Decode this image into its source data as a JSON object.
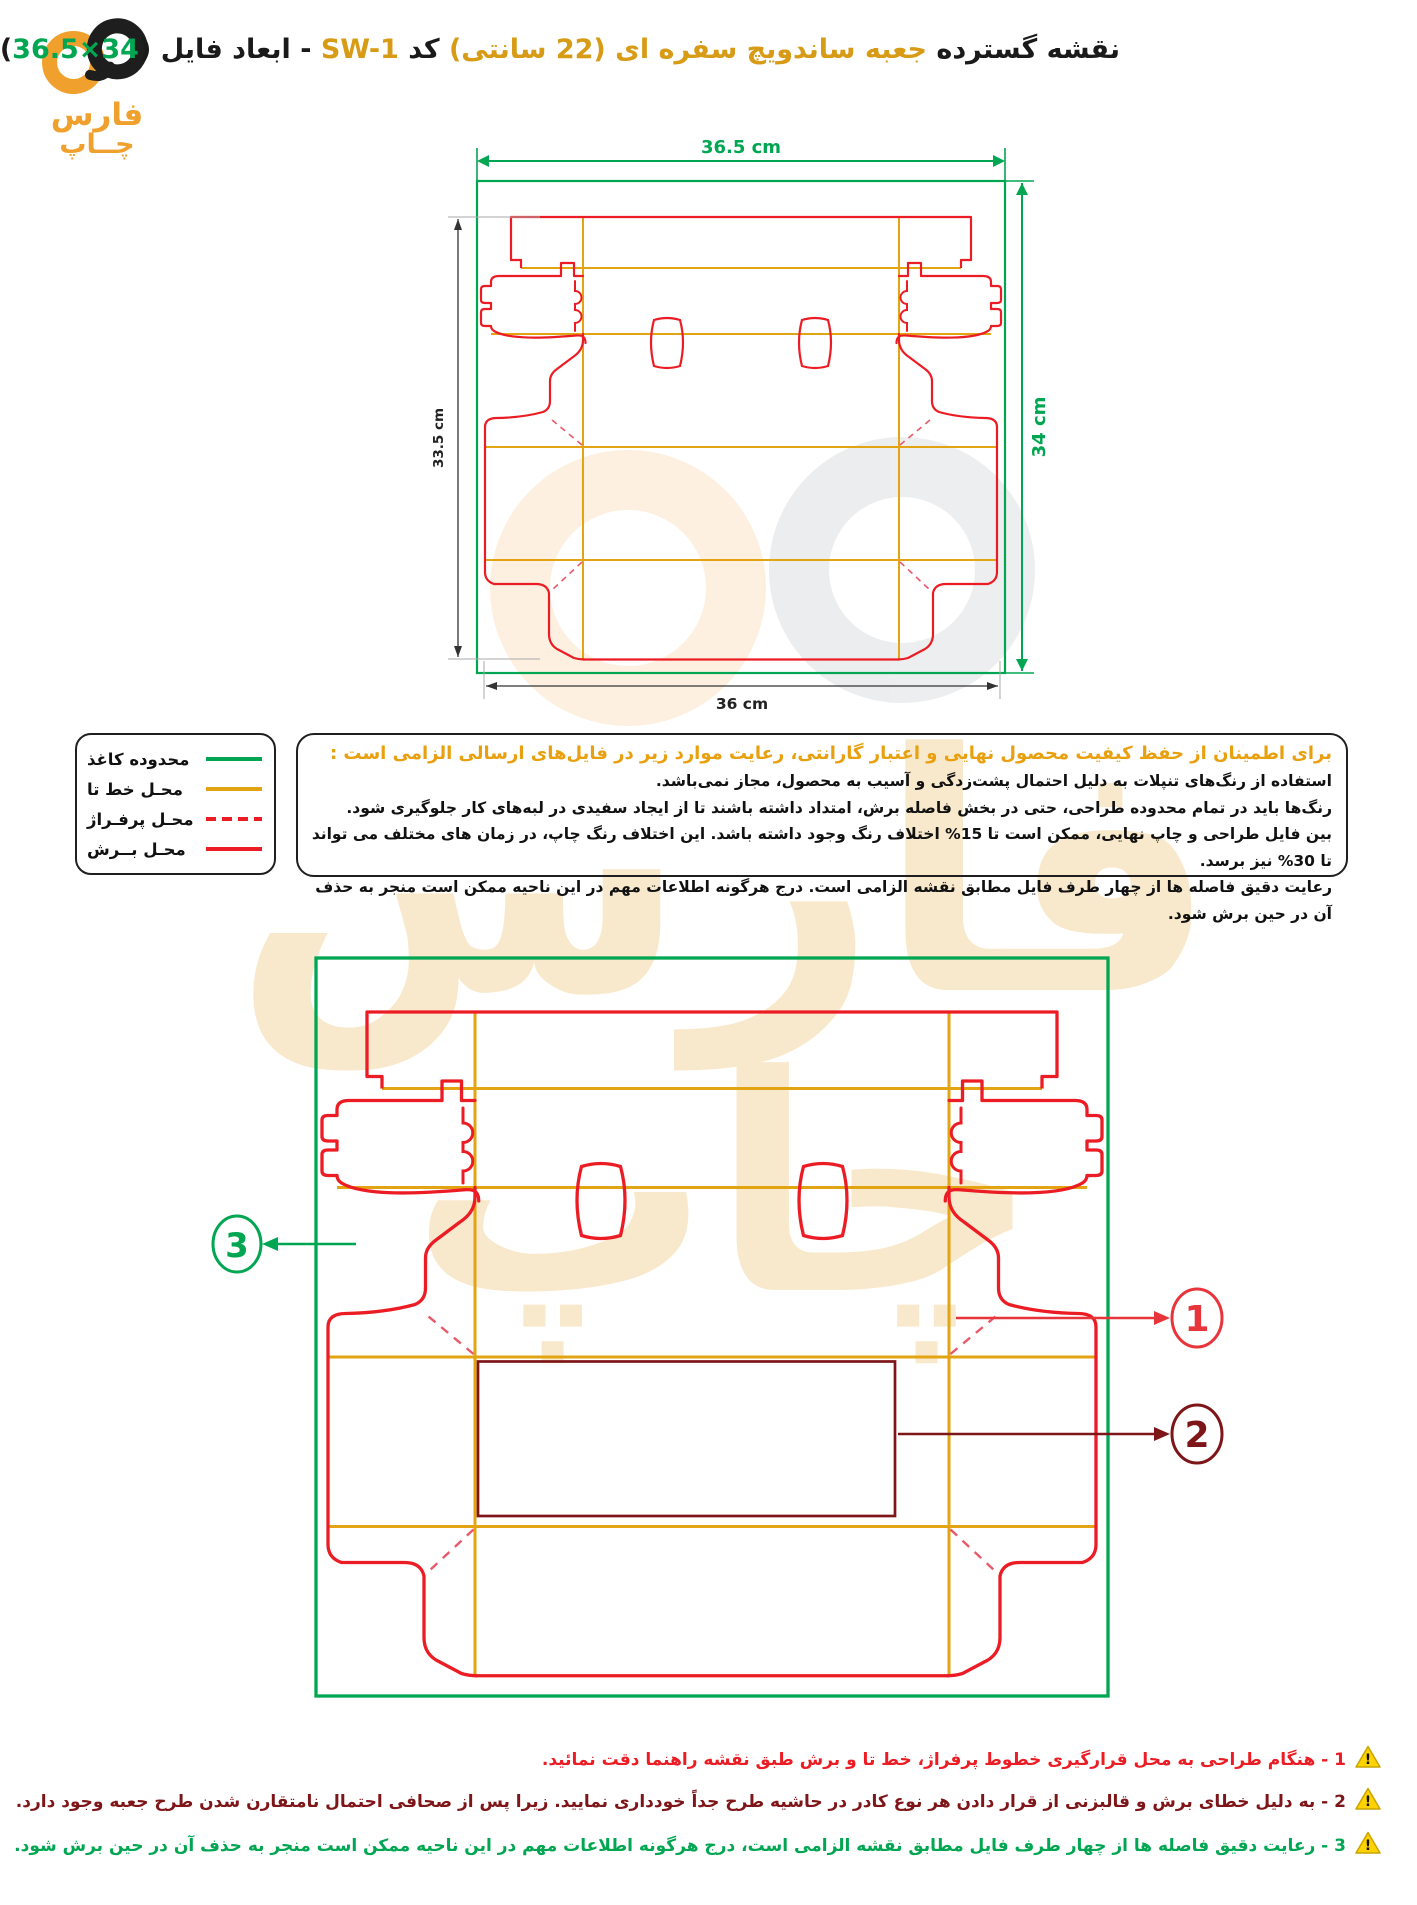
{
  "colors": {
    "paper_boundary_green": "#00A651",
    "fold_yellow": "#E2A412",
    "cut_red": "#EC1C24",
    "perforation_red": "#E8596A",
    "frame_maroon": "#7E1518",
    "brand_orange": "#F0A02C",
    "title_orange": "#D89B16",
    "heading_orange": "#E8A00E",
    "warning_yellow": "#FFD200"
  },
  "header": {
    "logo": {
      "symbol": "infinity-icon",
      "line1": "فارس",
      "line2": "چــاپ"
    },
    "title": {
      "part1": "نقشه گسترده ",
      "part2": "جعبه ساندویچ سفره ای (22 سانتی)",
      "part3": " کد ",
      "code": "SW-1",
      "part4": " - ابعاد فایل (",
      "file_size": "36.5×34",
      "part5": ")"
    }
  },
  "drawing1": {
    "dim_top": "36.5 cm",
    "dim_right": "34 cm",
    "dim_left": "33.5 cm",
    "dim_bottom": "36 cm"
  },
  "legend": {
    "items": [
      {
        "label": "محدوده کاغذ",
        "line": "green-solid"
      },
      {
        "label": "محـل خط تا",
        "line": "yellow-solid"
      },
      {
        "label": "محـل پرفـراژ",
        "line": "red-dashed"
      },
      {
        "label": "محـل بــرش",
        "line": "red-solid"
      }
    ]
  },
  "instructions": {
    "heading": "برای اطمینان از حفظ کیفیت محصول نهایی و اعتبار گارانتی، رعایت موارد زیر در فایل‌های ارسالی الزامی است :",
    "lines": [
      "استفاده از رنگ‌های تنپلات به دلیل احتمال پشت‌زدگی و آسیب به محصول، مجاز نمی‌باشد.",
      "رنگ‌ها باید در تمام محدوده طراحی، حتی در بخش فاصله برش، امتداد داشته باشند تا از ایجاد سفیدی در لبه‌های کار جلوگیری شود.",
      "بین فایل طراحی و چاپ نهایی، ممکن است تا 15% اختلاف رنگ وجود داشته باشد. این اختلاف رنگ چاپ، در زمان های مختلف می تواند تا 30% نیز برسد.",
      "رعایت دقیق فاصله ها از چهار طرف فایل مطابق نقشه الزامی است. درج هرگونه اطلاعات مهم در این ناحیه ممکن است منجر به حذف آن در حین برش شود."
    ]
  },
  "drawing2": {
    "callouts": [
      {
        "num": "1"
      },
      {
        "num": "2"
      },
      {
        "num": "3"
      }
    ]
  },
  "watermark": {
    "line1": "فارس",
    "line2": "چاپ"
  },
  "notes": {
    "warning_glyph": "!",
    "items": [
      {
        "text": "1 - هنگام طراحی به محل قرارگیری خطوط پرفراژ، خط تا و برش طبق نقشه راهنما دقت نمائید."
      },
      {
        "text": "2 - به دلیل خطای برش و قالبزنی از قرار دادن هر نوع کادر در حاشیه طرح جداً خودداری نمایید. زیرا پس از صحافی احتمال نامتقارن شدن طرح جعبه وجود دارد."
      },
      {
        "text": "3 - رعایت دقیق فاصله ها از چهار طرف فایل مطابق نقشه الزامی است، درج هرگونه اطلاعات مهم در این ناحیه ممکن است منجر به حذف آن در حین برش شود."
      }
    ]
  }
}
